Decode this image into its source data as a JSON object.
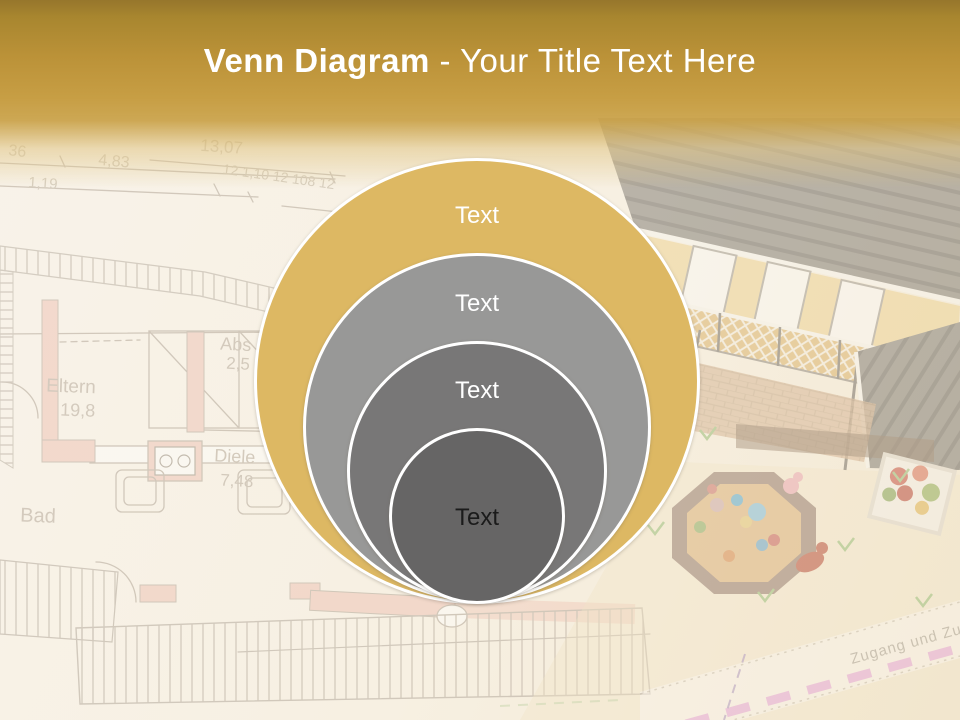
{
  "slide_title": {
    "keyword": "Venn Diagram",
    "separator_and_rest": "- Your Title Text Here"
  },
  "diagram": {
    "type": "stacked-venn",
    "rings": [
      {
        "label": "Text",
        "fill": "#DDB863",
        "label_color": "#FFFFFF"
      },
      {
        "label": "Text",
        "fill": "#989897",
        "label_color": "#FFFFFF"
      },
      {
        "label": "Text",
        "fill": "#787777",
        "label_color": "#FFFFFF"
      },
      {
        "label": "Text",
        "fill": "#666565",
        "label_color": "#1B1B1B"
      }
    ],
    "ring_border_color": "#FFFFFF"
  },
  "background": {
    "header_gold_top": "#96762C",
    "header_gold_bottom": "#C79E44",
    "floor_plan": {
      "dimensions": [
        "36",
        "4,83",
        "1,19",
        "13,07",
        "12 1,10 12 108 12"
      ],
      "rooms": [
        {
          "name": "Eltern",
          "size": "19,8"
        },
        {
          "name": "Abs",
          "size": "2,5"
        },
        {
          "name": "Diele",
          "size": "7,48"
        },
        {
          "name": "Bad",
          "size": ""
        }
      ]
    },
    "site_plan": {
      "path_label": "Zugang und Zufahrt"
    }
  }
}
